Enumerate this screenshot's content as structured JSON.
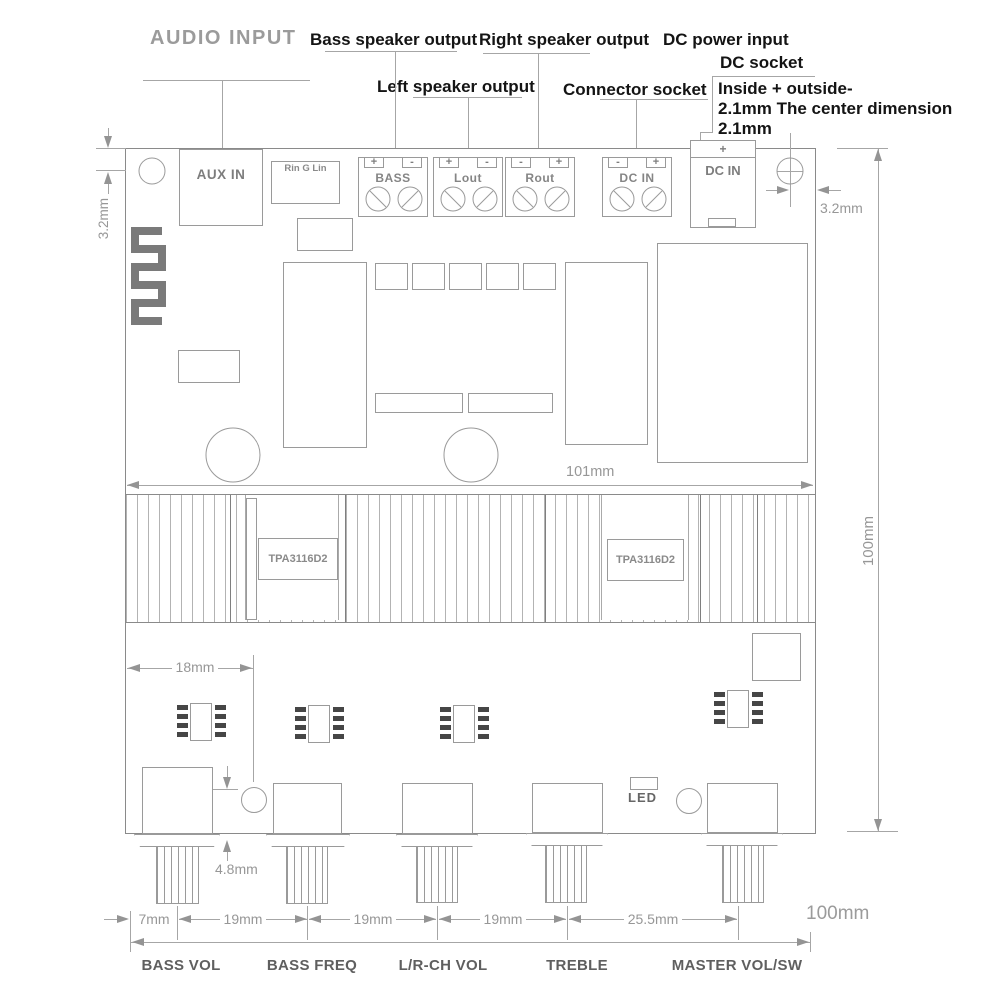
{
  "title": "AUDIO INPUT",
  "top_labels": {
    "bass_speaker_output": "Bass speaker output",
    "right_speaker_output": "Right speaker output",
    "dc_power_input": "DC power input",
    "dc_socket": "DC socket",
    "left_speaker_output": "Left speaker output",
    "connector_socket": "Connector socket",
    "dc_note_line1": "Inside + outside-",
    "dc_note_line2": "2.1mm  The center dimension",
    "dc_note_line3": "2.1mm"
  },
  "connectors": {
    "aux_in": "AUX IN",
    "rin_g_lin": "Rin G  Lin",
    "terminals": [
      {
        "label": "BASS",
        "sl": "+",
        "sr": "-"
      },
      {
        "label": "Lout",
        "sl": "+",
        "sr": "-"
      },
      {
        "label": "Rout",
        "sl": "-",
        "sr": "+"
      },
      {
        "label": "DC IN",
        "sl": "-",
        "sr": "+"
      }
    ],
    "dc_jack": {
      "label": "DC IN",
      "sign": "+"
    }
  },
  "chips": {
    "amp_left": "TPA3116D2",
    "amp_right": "TPA3116D2"
  },
  "led_label": "LED",
  "dimensions": {
    "hole_edge_left": "3.2mm",
    "hole_edge_right": "3.2mm",
    "width_mid": "101mm",
    "height_right": "100mm",
    "pot_offset": "18mm",
    "button_offset": "4.8mm",
    "seg_7": "7mm",
    "seg_19_1": "19mm",
    "seg_19_2": "19mm",
    "seg_19_3": "19mm",
    "seg_25_5": "25.5mm",
    "width_bottom": "100mm"
  },
  "controls": [
    {
      "label": "BASS VOL"
    },
    {
      "label": "BASS FREQ"
    },
    {
      "label": "L/R-CH VOL"
    },
    {
      "label": "TREBLE"
    },
    {
      "label": "MASTER VOL/SW"
    }
  ]
}
